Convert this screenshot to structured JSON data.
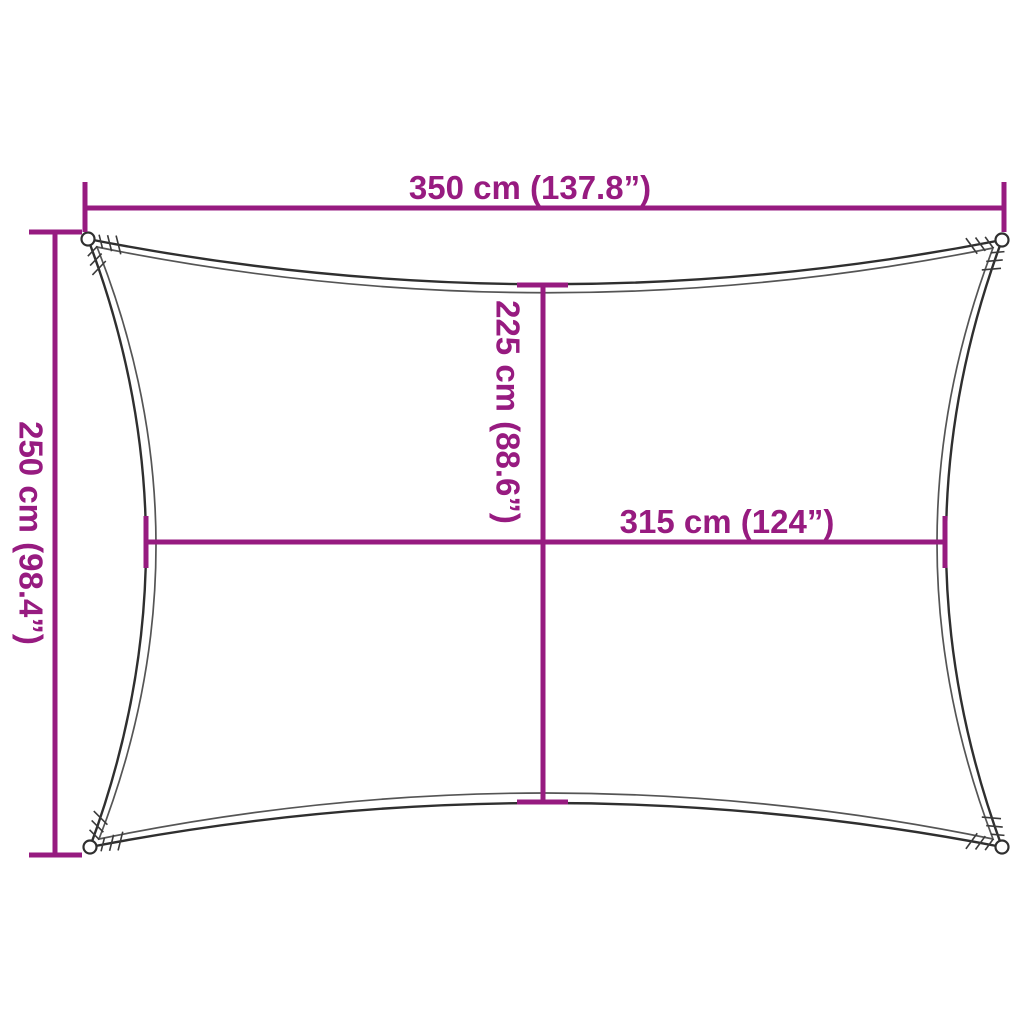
{
  "diagram": {
    "type": "shade-sail-dimension-drawing",
    "dimensions": {
      "outer_width": {
        "label": "350 cm (137.8”)",
        "value_cm": 350,
        "value_in": 137.8
      },
      "outer_height": {
        "label": "250 cm (98.4”)",
        "value_cm": 250,
        "value_in": 98.4
      },
      "inner_height": {
        "label": "225 cm (88.6”)",
        "value_cm": 225,
        "value_in": 88.6
      },
      "inner_width": {
        "label": "315 cm (124”)",
        "value_cm": 315,
        "value_in": 124
      }
    },
    "colors": {
      "dimension_lines": "#971b80",
      "sail_outline": "#2f2f2f",
      "sail_inner_line": "#555555",
      "background": "#ffffff"
    }
  }
}
